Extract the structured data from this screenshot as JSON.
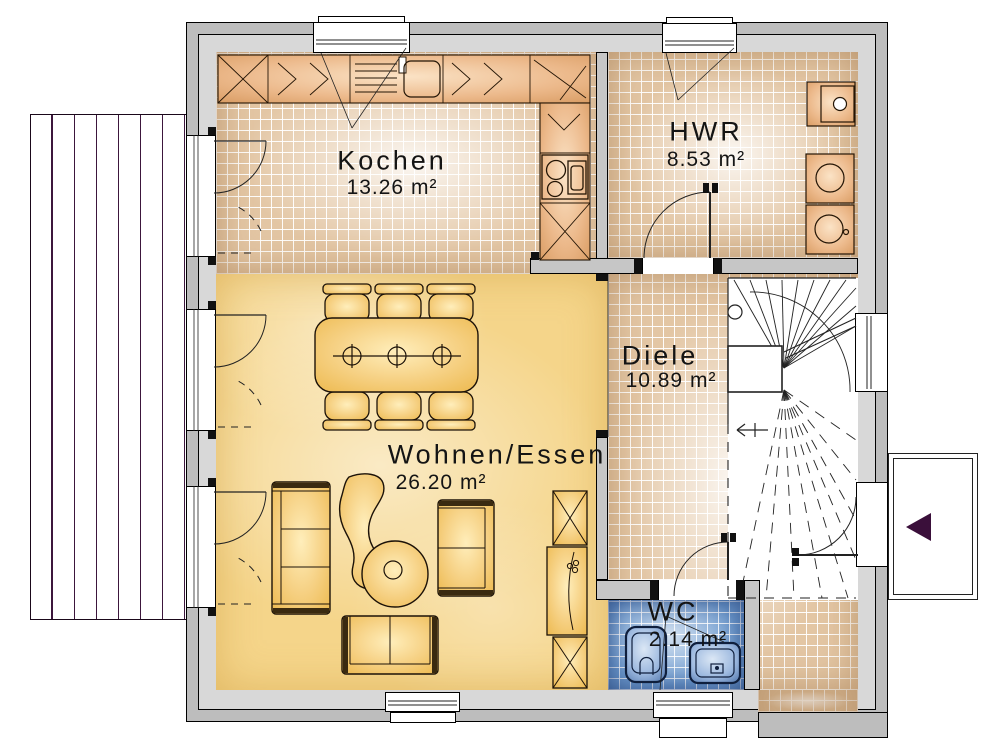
{
  "plan": {
    "rooms": [
      {
        "key": "kochen",
        "label": "Kochen",
        "area": "13.26 m²"
      },
      {
        "key": "hwr",
        "label": "HWR",
        "area": "8.53 m²"
      },
      {
        "key": "diele",
        "label": "Diele",
        "area": "10.89 m²"
      },
      {
        "key": "wohnen_essen",
        "label": "Wohnen/Essen",
        "area": "26.20 m²"
      },
      {
        "key": "wc",
        "label": "WC",
        "area": "2.14 m²"
      }
    ],
    "colors": {
      "tile_beige": "#e3c6a4",
      "floor_yellow": "#f5d58a",
      "tile_blue": "#6f9cd0",
      "furniture_gold": "#f3cd74",
      "counter_tan": "#e8b587",
      "wall_outer": "#bdbdbd",
      "wall_inner": "#d8d8d8",
      "wall_interior": "#c6c6c6",
      "entrance_arrow": "#3a0f3a",
      "terrace_line": "#3c163c"
    }
  }
}
